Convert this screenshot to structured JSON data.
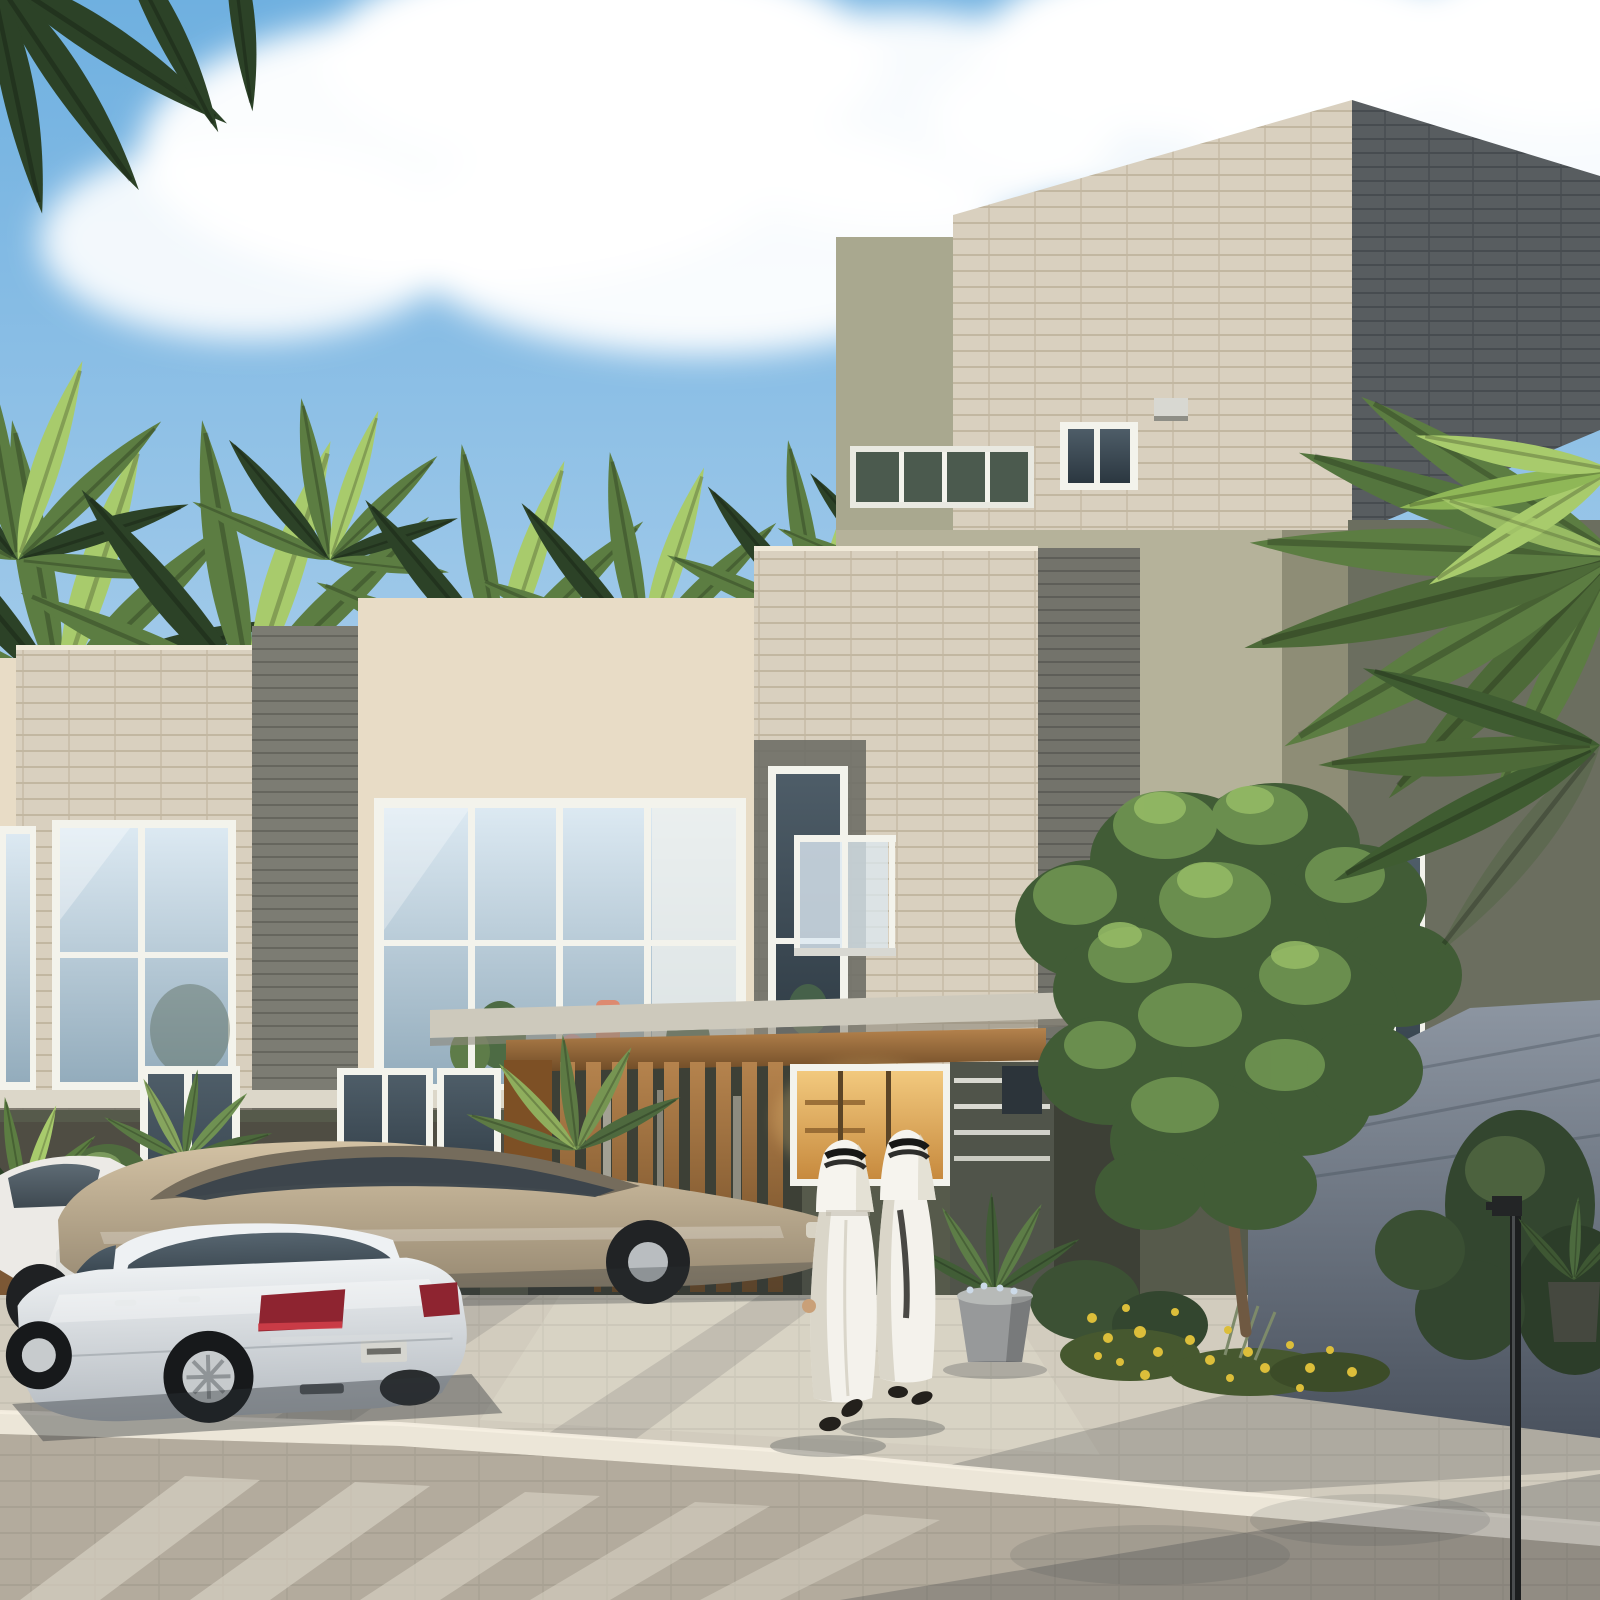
{
  "scene": {
    "title": "Modern villa community street view",
    "type": "architectural-rendering",
    "description": "Sunlit 3D architectural rendering of a modern sand-stone and olive-green townhouse and villa community with palm trees, a leafy street tree, three parked sedans, and two men in white kanduras walking along a paved sidewalk under a blue sky with scattered white clouds.",
    "time_of_day": "daytime",
    "weather": "sunny with scattered clouds",
    "counts": {
      "pedestrians": 2,
      "cars": 3,
      "palm_clusters": 9
    },
    "elements": [
      {
        "name": "sky",
        "label": "Blue sky with white clouds"
      },
      {
        "name": "townhouse-row",
        "label": "Two-storey townhouses with stone pillars, beige stucco and large white-framed windows"
      },
      {
        "name": "villa",
        "label": "Olive-green villa with stone-clad roof tower, clerestory windows and glass balcony"
      },
      {
        "name": "pergola",
        "label": "Wooden carport pergola and slatted timber entry screen"
      },
      {
        "name": "cars",
        "label": "Three parked sedans: silver, champagne and white"
      },
      {
        "name": "pedestrians",
        "label": "Two men in white kanduras and ghutras walking away"
      },
      {
        "name": "tree",
        "label": "Green street tree in front of the villa"
      },
      {
        "name": "palms",
        "label": "Palm trees behind the rooftops and at the right edge"
      },
      {
        "name": "garden",
        "label": "Shadowed blue-grey boundary wall with shrubs and yellow flowers"
      },
      {
        "name": "street",
        "label": "Paved sidewalk, white curb stones and block-paved road with crosswalk stripes"
      },
      {
        "name": "street-lamp",
        "label": "Black street lamp pole"
      },
      {
        "name": "planters",
        "label": "Concrete, timber and dark planters with desert plants"
      }
    ]
  },
  "palette": {
    "sky_top": "#6fb0e0",
    "sky_mid": "#a3cbea",
    "sky_low": "#d8e9f5",
    "cloud": "#ffffff",
    "stone_light": "#d9d0bf",
    "stone_line": "#bdb09a",
    "stone_dark": "#585d60",
    "stone_dark_line": "#474c50",
    "stone_side": "#73736b",
    "stucco_beige": "#e8dcc6",
    "stucco_shade": "#cabca5",
    "sage": "#a9a88f",
    "sage_light": "#b5b29a",
    "sage_shade": "#8e8d76",
    "olive_mid": "#6b6e5f",
    "olive_dark": "#565a4b",
    "olive_deep": "#3d4036",
    "gray_pillar": "#7c7c73",
    "frame_white": "#f3f3ec",
    "glass_hi": "#dce9f2",
    "glass_lo": "#93acbc",
    "dark_hi": "#4e5d68",
    "dark_lo": "#2b3740",
    "warm_hi": "#f2c97e",
    "warm_lo": "#c78a3e",
    "wood_hi": "#b5834d",
    "wood_lo": "#6f4b26",
    "sidewalk": "#d2ccbe",
    "curb": "#ece6d8",
    "road": "#b3ab9d",
    "tree_green": "#415c36",
    "tree_light": "#6d9150",
    "tree_bright": "#96bc66",
    "palm_green": "#5c7d42",
    "palm_light": "#a8cb6c",
    "palm_dark": "#2c4227",
    "kandura": "#f4f2ec",
    "kandura_shade": "#cfcaba",
    "agal": "#181816",
    "skin": "#c9a078",
    "silver_hi": "#eef1f3",
    "silver_lo": "#b4bac0",
    "champagne_hi": "#d3c2a4",
    "champagne_lo": "#978972",
    "car_white": "#eceae6",
    "tail_red": "#c23434",
    "tail_dark": "#8e2430",
    "tint": "#3a434b",
    "planter_gray": "#97999a",
    "planter_dark": "#3a3d37",
    "planter_wood": "#7c5835",
    "pot_white": "#e6e4dc",
    "flower_yellow": "#dcbe3a",
    "wall_hi": "#8d96a2",
    "wall_lo": "#4a525e",
    "lamp_black": "#1c1e1f",
    "shadow": "#2c3136"
  }
}
